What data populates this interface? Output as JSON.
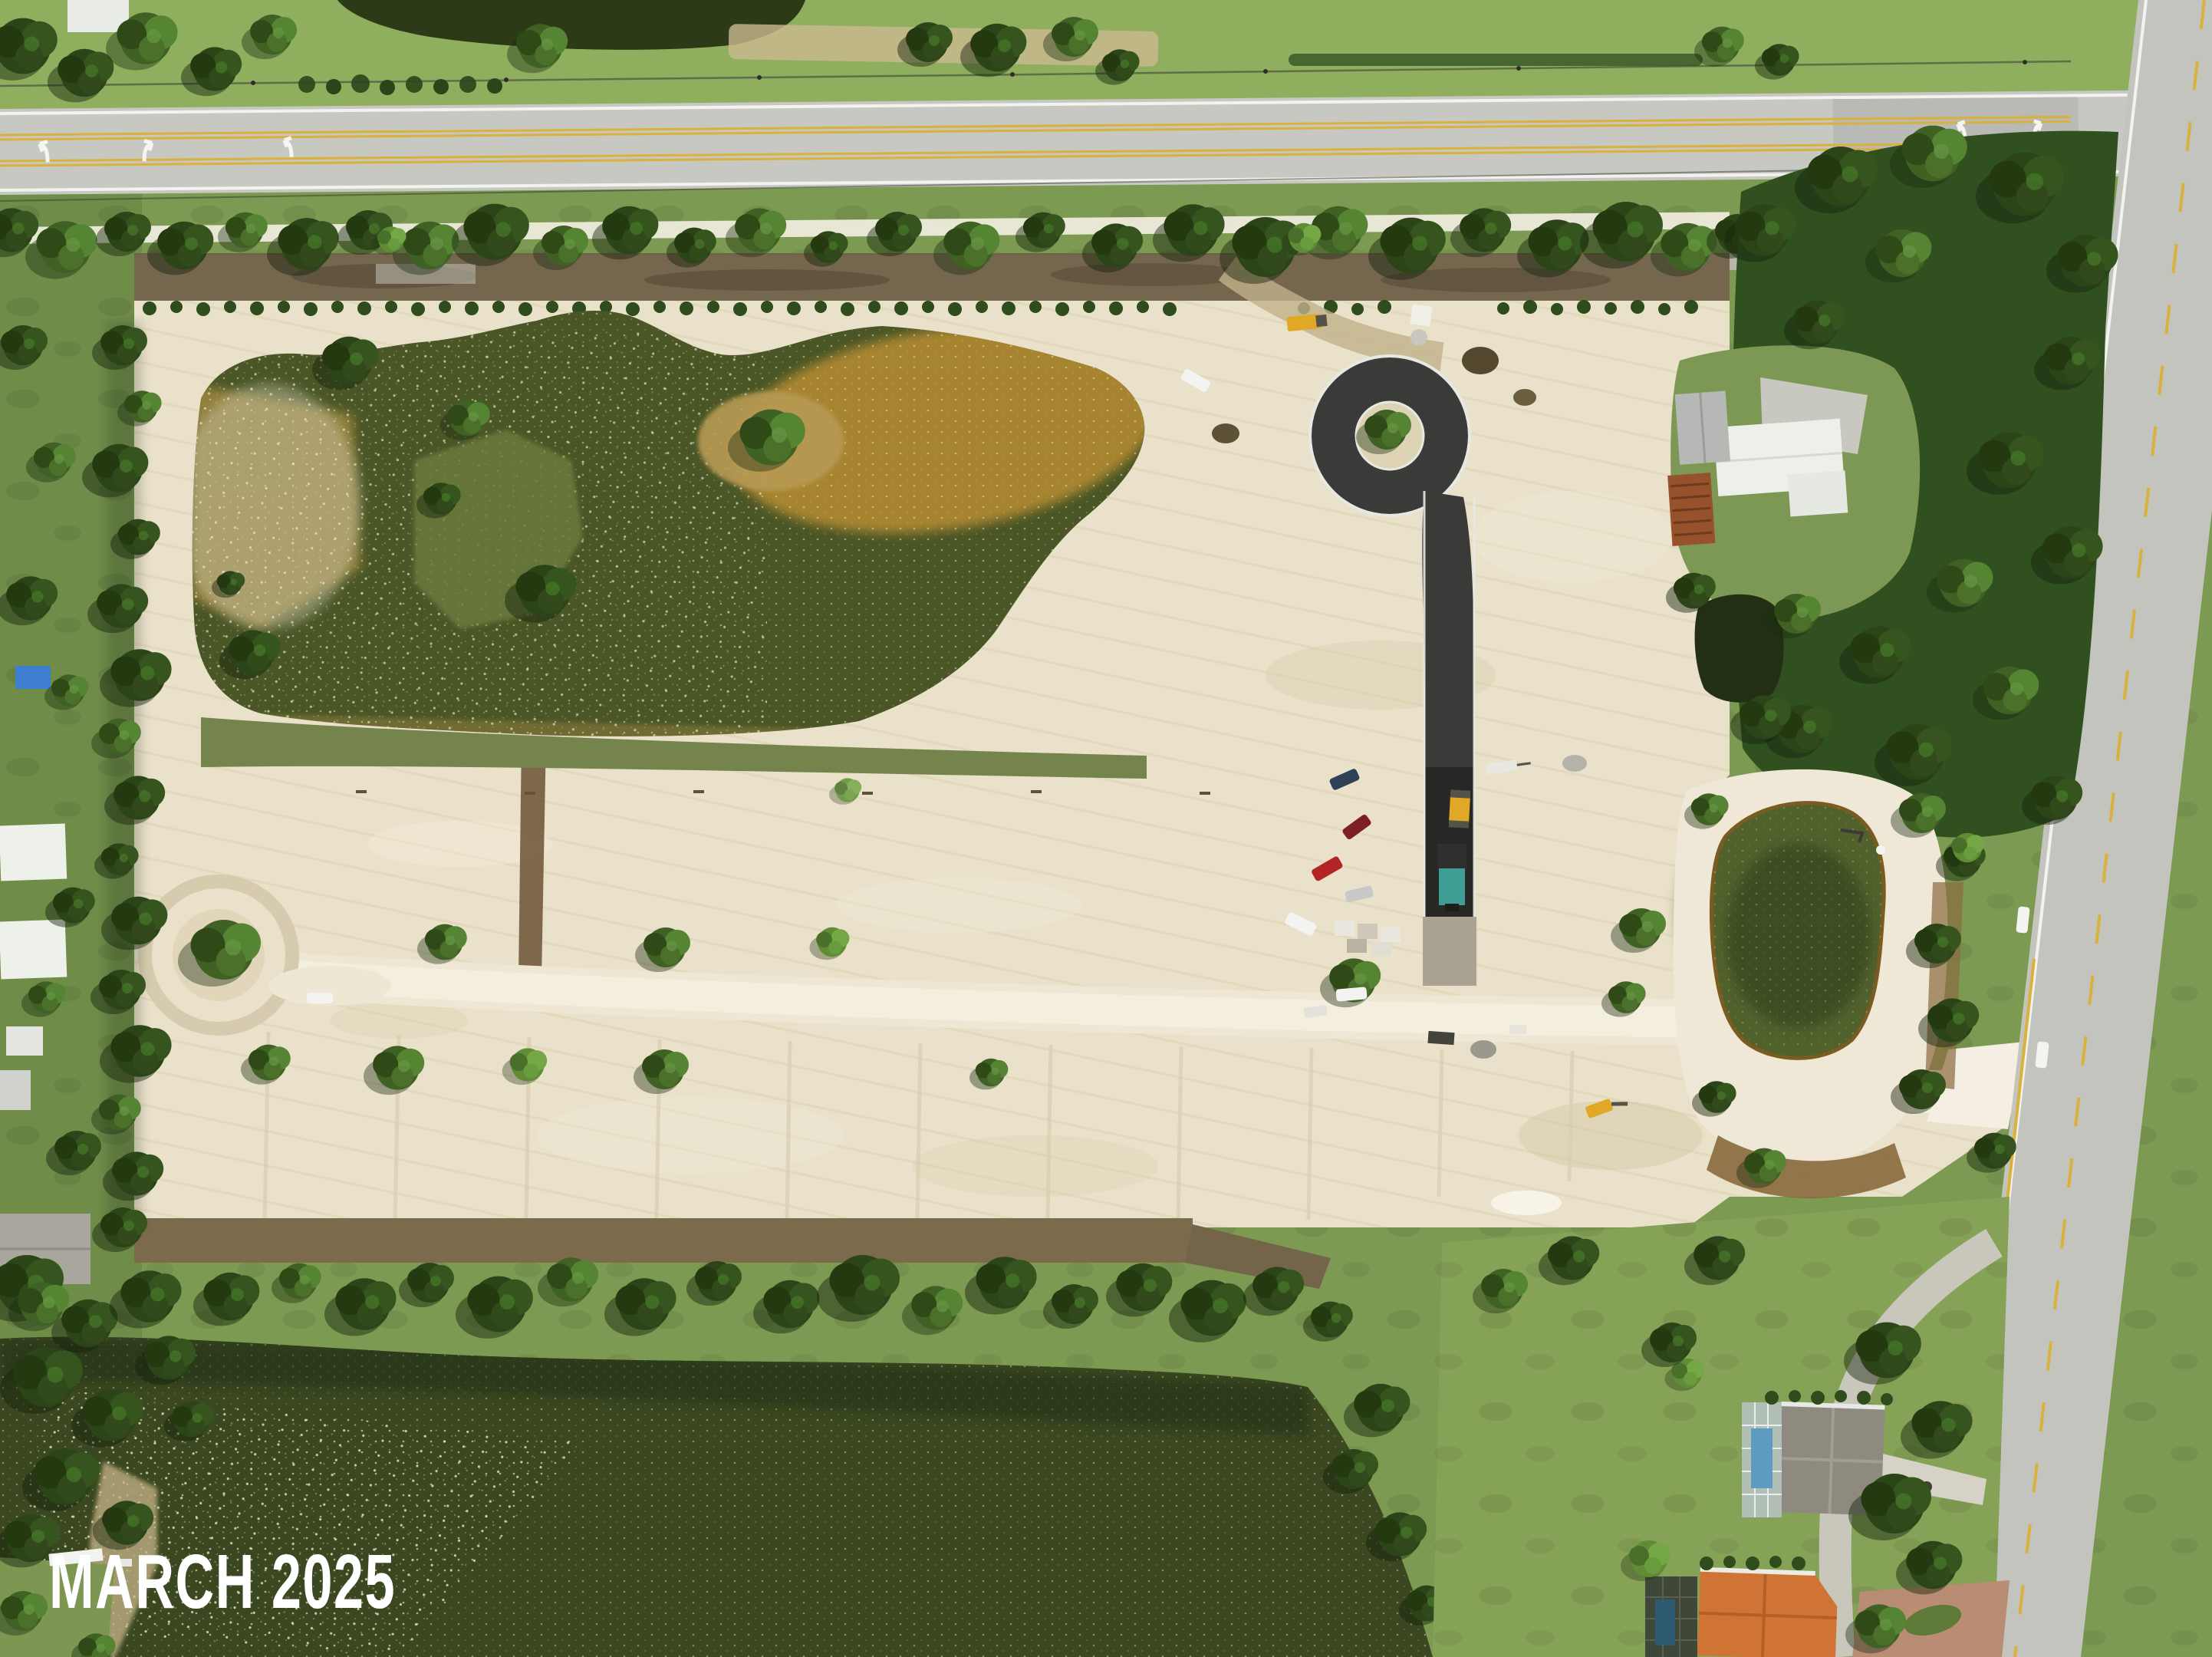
{
  "overlay": {
    "date_label": "MARCH 2025"
  },
  "palette": {
    "label": "#ffffff",
    "grass": "#7d9a52",
    "grass_bright": "#8fae5e",
    "lawn": "#86a257",
    "tree_dark": "#2b4519",
    "sand": "#e9e1ca",
    "sand_bright": "#f4efdf",
    "dirt_road": "#eee7d3",
    "dark_dirt": "#6f6047",
    "berm": "#7b6a4c",
    "asphalt": "#3a3a38",
    "fresh_asphalt": "#272726",
    "highway": "#c8c8c3",
    "cross_road": "#c4c4bf",
    "line_white": "#f2f2ee",
    "line_yellow": "#d9b13b",
    "pond_water": "#4a5626",
    "pond_shallow": "#b28a33",
    "small_pond": "#232f15",
    "right_pond": "#51612c",
    "lake_water": "#3a4720",
    "sparkle": "#dfe8c0",
    "white_roof": "#edefe9",
    "gray_roof": "#8f8a80",
    "orange_roof": "#cf7434",
    "rust_roof": "#96522a",
    "pool_blue": "#5e9bc0",
    "car_red": "#b32425",
    "car_dark_red": "#7e1f26",
    "car_navy": "#2e4156",
    "car_silver": "#c6c9c8",
    "truck_white": "#f3f4f1",
    "machine_yellow": "#e0a826",
    "paver_teal": "#3f9e94",
    "mulch": "#8a6b40"
  }
}
